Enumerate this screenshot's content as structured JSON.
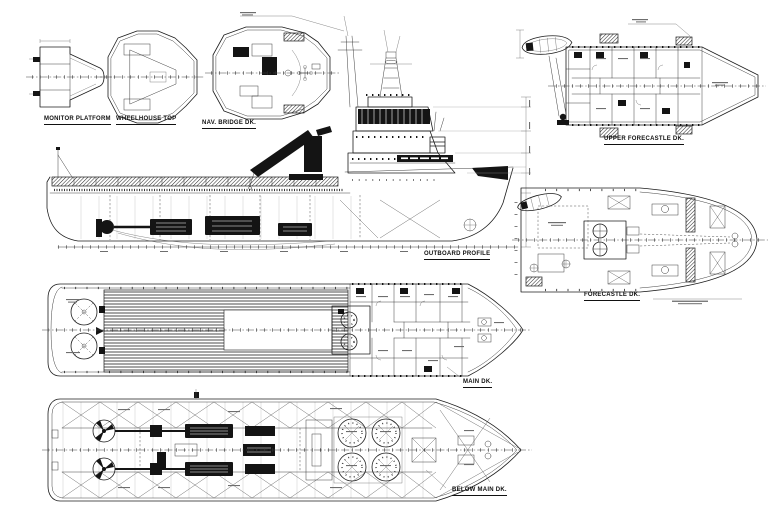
{
  "drawing": {
    "type": "ship-general-arrangement-plan",
    "background_color": "#ffffff",
    "line_color": "#1c1c1c",
    "views": [
      {
        "id": "monitor-platform",
        "label": "MONITOR PLATFORM"
      },
      {
        "id": "wheelhouse-top",
        "label": "WHEELHOUSE TOP"
      },
      {
        "id": "nav-bridge-dk",
        "label": "NAV. BRIDGE DK."
      },
      {
        "id": "upper-forecastle-dk",
        "label": "UPPER FORECASTLE DK."
      },
      {
        "id": "outboard-profile",
        "label": "OUTBOARD PROFILE"
      },
      {
        "id": "forecastle-dk",
        "label": "FORECASTLE DK."
      },
      {
        "id": "main-dk",
        "label": "MAIN DK."
      },
      {
        "id": "below-main-dk",
        "label": "BELOW MAIN DK."
      }
    ]
  }
}
